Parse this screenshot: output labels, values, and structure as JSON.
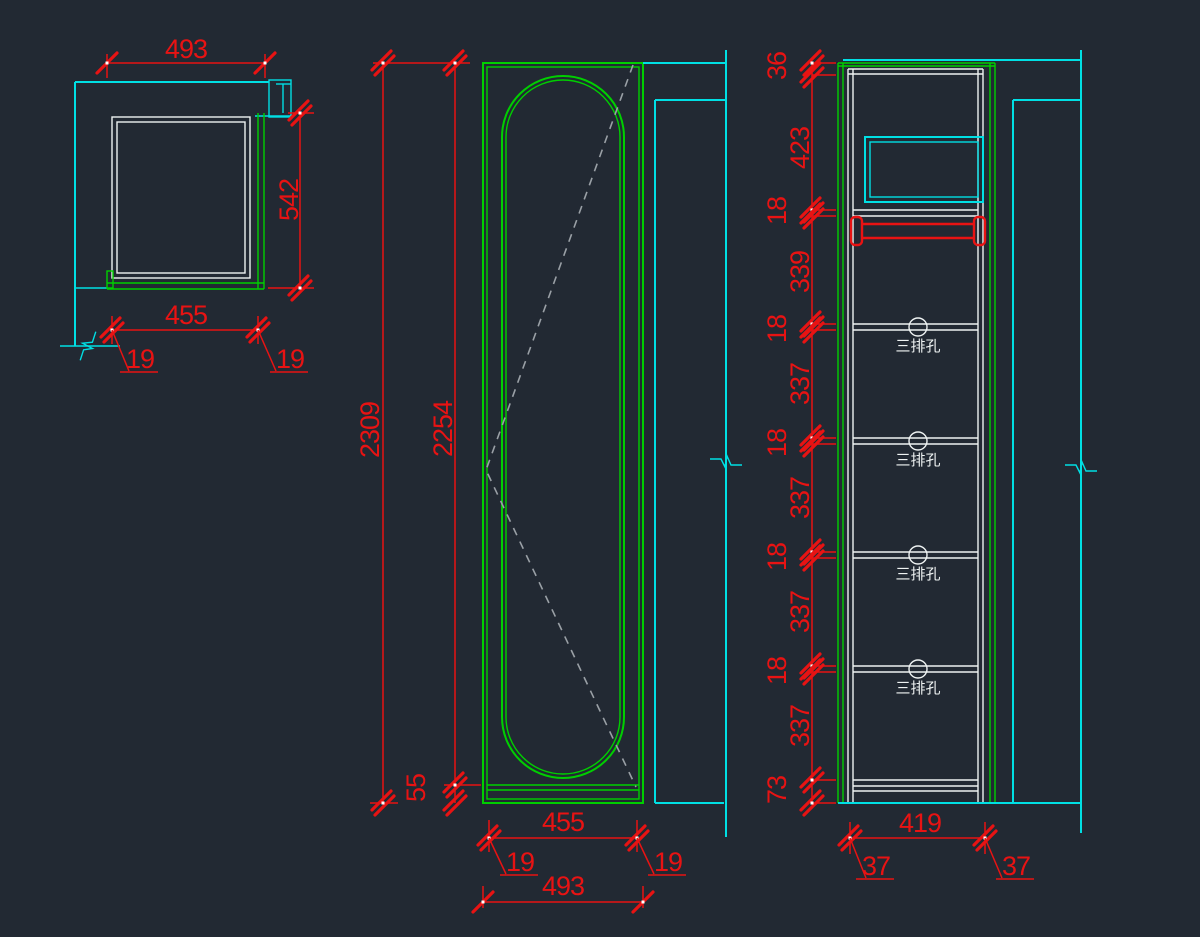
{
  "colors": {
    "background": "#222933",
    "wall_lines": "#00dfe4",
    "cabinet_lines": "#00cf00",
    "dimension_lines": "#e81313",
    "internal_lines": "#eef2f2",
    "door_swing_dash": "#9aa0a6"
  },
  "plan": {
    "width_top": "493",
    "depth": "542",
    "width_bottom": "455",
    "thickness_left": "19",
    "thickness_right": "19"
  },
  "front": {
    "height_total": "2309",
    "height_door": "2254",
    "bottom_rail": "55",
    "width_inner": "455",
    "thickness_left": "19",
    "thickness_right": "19",
    "width_total": "493"
  },
  "section": {
    "chain": [
      "36",
      "423",
      "18",
      "339",
      "18",
      "337",
      "18",
      "337",
      "18",
      "337",
      "18",
      "337",
      "73"
    ],
    "hole_label": "三排孔",
    "width_inner": "419",
    "offset_left": "37",
    "offset_right": "37"
  }
}
